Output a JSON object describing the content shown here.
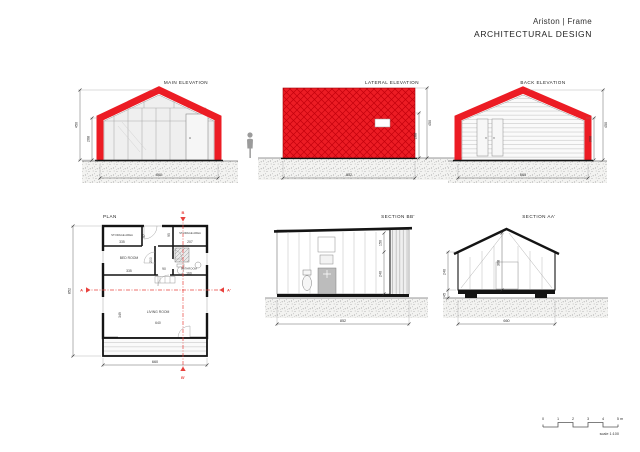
{
  "header": {
    "title": "Ariston | Frame",
    "subtitle": "ARCHITECTURAL DESIGN"
  },
  "palette": {
    "frame_red": "#ec1c24",
    "section_marker_red": "#e8413d",
    "drawing_black": "#141414",
    "ground_gray": "#bdbdbd"
  },
  "views": {
    "main_elevation": {
      "title": "MAIN ELEVATION",
      "dims": {
        "overall_height": "450",
        "wall_height": "268",
        "width": "660"
      }
    },
    "lateral_elevation": {
      "title": "LATERAL ELEVATION",
      "dims": {
        "overall_height": "450",
        "wall_height": "288",
        "width": "852"
      }
    },
    "back_elevation": {
      "title": "BACK ELEVATION",
      "dims": {
        "overall_height": "450",
        "wall_height": "268",
        "width": "660"
      }
    },
    "plan": {
      "title": "PLAN",
      "rooms": {
        "storage_left": {
          "label": "STORAGE AREA",
          "width": "335",
          "depth": "97"
        },
        "storage_right": {
          "label": "STORAGE AREA",
          "width": "207",
          "depth": "95"
        },
        "bedroom": {
          "label": "BED ROOM",
          "width": "335",
          "depth": "200"
        },
        "bathroom": {
          "label": "BATHROOM",
          "width": "160"
        },
        "living_room": {
          "label": "LIVING ROOM",
          "width": "640",
          "depth": "349"
        },
        "hall": {
          "width": "90"
        }
      },
      "dims": {
        "overall_depth": "852",
        "overall_width": "660"
      },
      "section_markers": {
        "a": "A",
        "a_prime": "A'",
        "b": "B",
        "b_prime": "B'"
      }
    },
    "section_bb": {
      "title": "SECTION BB'",
      "dims": {
        "roof_zone": "150",
        "wall_height": "240",
        "width": "852"
      }
    },
    "section_aa": {
      "title": "SECTION AA'",
      "dims": {
        "wall_height": "240",
        "base_height": "45",
        "ridge_height": "368",
        "width": "660"
      }
    }
  },
  "scale_bar": {
    "ticks": [
      "0",
      "1",
      "2",
      "3",
      "4",
      "5 m"
    ],
    "label": "scale 1:100"
  }
}
